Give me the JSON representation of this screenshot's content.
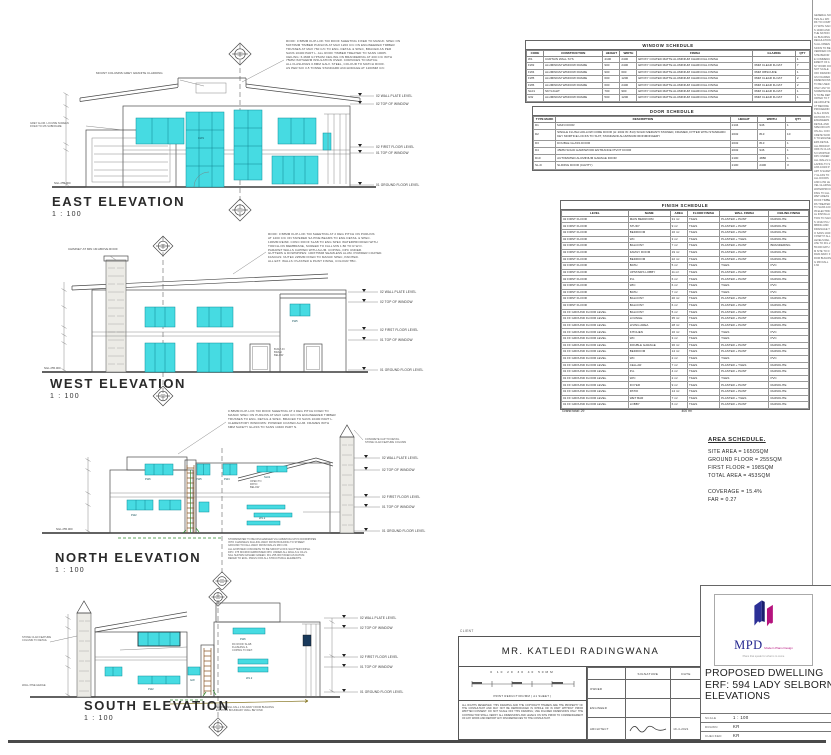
{
  "levels": [
    "02 WALL PLATE LEVEL",
    "02 TOP OF WINDOW",
    "02 FIRST FLOOR LEVEL",
    "01 TOP OF WINDOW",
    "01 GROUND FLOOR LEVEL"
  ],
  "ngl": "NGL 255.000",
  "win_tags": [
    "FW6",
    "FW5",
    "FW4",
    "FW2",
    "W1.2",
    "GW",
    "SL01",
    "CW1"
  ],
  "elevations": {
    "east": {
      "label": "EAST ELEVATION",
      "scale": "1 : 100"
    },
    "west": {
      "label": "WEST ELEVATION",
      "scale": "1 : 100"
    },
    "north": {
      "label": "NORTH ELEVATION",
      "scale": "1 : 100"
    },
    "south": {
      "label": "SOUTH ELEVATION",
      "scale": "1 : 100"
    }
  },
  "notes": {
    "east": [
      "ROOF: 0.58MM KLIP-LOK 700 ROOF SHEETING FIXED TO MANUF. SPEC ON",
      "50X76MM TIMBER PURLINS AT MAX 1200 C/C ON ENGINEERED TIMBER",
      "TRUSSES AT MAX 760 C/C TO ENG. DETAIL & SPEC, BRACED AS PER",
      "SANS 10400 PART L. ALL ROOF TIMBER TREATED TO SANS 10005.",
      "CEILING: 6.4MM GYPSUM CEILING ON BRANDERING AT 400 C/C WITH",
      "75MM ISOTHERM INSULATION OVER. CORNICES TO MATCH.",
      "ALL FLASHINGS 0.8MM GALV. STEEL, COLOUR TO MATCH ROOF.",
      "AS PER SOI 3-5 TONNE STANDARD ANCHORAGE AT 1200MM C/C"
    ],
    "east_left": [
      "GREY ALUM. LOUVRE SCREEN",
      "FIXED TO MS SUBFRAME"
    ],
    "east_callout": "MOUNT COLUMNS GREY GRANITE CLADDING",
    "west": [
      "ROOF: 0.58MM KLIP-LOK 700 SHEETING AT 2 DEG PITCH ON PURLINS",
      "AT 1200 C/C ON TAPERED SA PINE BEAMS TO ENG DETAIL & SPEC.",
      "130MM REINF. CONC ROOF SLAB TO ENG SPEC WATERPROOFED WITH",
      "TORCH-ON MEMBRANE, SCREED TO FALL MIN 1:80 TO R.W.O.",
      "PARAPET WALLS CAPPED WITH ALUM. COPING, DPC UNDER.",
      "GUTTERS & DOWNPIPES: 100X75MM SEAMLESS ALUM. POWDER COATED.",
      "FASCIAS: NUTEC 225MM FIXED TO MANUF SPEC, PAINTED.",
      "ALL EXT. WALLS: PLASTER & PAINT FINISH, COLOUR TBC."
    ],
    "west_callout": "CHIMNEY AT MIN 1M ABOVE ROOF",
    "west_mid": [
      "BUILT-IN",
      "BRAAI",
      "BELOW"
    ],
    "north_top": [
      "0.58MM KLIP-LOK 700 ROOF SHEETING AT 2 DEG PITCH FIXED TO",
      "MANUF SPEC ON PURLINS AT MAX 1200 C/C ON ENGINEERED TIMBER",
      "TRUSSES TO ENG. DETAIL & SPEC. BRACED TO SANS 10400 PART L.",
      "CLERESTORY WINDOWS: POWDER COATED ALUM. FRAMES WITH",
      "6MM SAFETY GLASS TO SANS 10400 PART N."
    ],
    "north_tower": [
      "CONCRETE CAP TO DETAIL",
      "STONE CLAD FEATURE COLUMN"
    ],
    "north_right": [
      "OPEN TO",
      "PATIO",
      "BELOW"
    ],
    "north_bottom": [
      "STORMWATER TO BE DISCHARGED VIA 110MM DIA UPVC DOWNPIPES",
      "INTO CHANNELS FALLING AWAY FROM BUILDING TO STREET.",
      "GROUND TO FALL AWAY FROM WALLS MIN 1:60.",
      "ALL EXPOSED CONCRETE TO BE SMOOTH OFF-SHUTTER FINISH.",
      "DPC: 375 MICRON EMBOSSED DPC UNDER ALL WALLS & CILLS.",
      "NGL SHOWN DASHED GREEN. FFL 255.000 TAKEN AS DATUM.",
      "REFER TO ENG. DWGS FOR ALL STRUCTURAL ELEMENTS."
    ],
    "south_left": [
      "STONE CLAD FEATURE",
      "COLUMN TO DETAIL"
    ],
    "south_hedge": "WALL PINE HEDGE",
    "south_mid": [
      "RC ROOF SLAB",
      "FLASHING &",
      "COPING TO DET."
    ],
    "south_olive": [
      "SLOPED NGL FALL 1:60 AWAY FROM BUILDING",
      "EXISTING BOUNDARY WALL BEYOND"
    ]
  },
  "window_schedule": {
    "title": "WINDOW SCHEDULE",
    "columns": [
      "CODE",
      "CONSTRUCTION",
      "HEIGHT",
      "WIDTH",
      "FINISH",
      "GLAZING",
      "QTY"
    ],
    "rows": [
      [
        "W1",
        "CURTAIN WALL SYS",
        "4100",
        "2400",
        "EPOXY COATED MATTE ALUMINIUM CHARCOAL FINISH",
        "",
        "1"
      ],
      [
        "FW2",
        "ALUMINIUM WINDOW FRAME",
        "900",
        "2400",
        "EPOXY COATED MATTE ALUMINIUM CHARCOAL FINISH",
        "6MM CLEAR FLOAT",
        "7"
      ],
      [
        "FW4",
        "ALUMINIUM WINDOW FRAME",
        "900",
        "600",
        "EPOXY COATED MATTE ALUMINIUM CHARCOAL FINISH",
        "6MM OBSCURE",
        "1"
      ],
      [
        "FW5",
        "ALUMINIUM WINDOW FRAME",
        "600",
        "1200",
        "EPOXY COATED MATTE ALUMINIUM CHARCOAL FINISH",
        "6MM CLEAR FLOAT",
        "2"
      ],
      [
        "FW6",
        "ALUMINIUM WINDOW FRAME",
        "600",
        "2400",
        "EPOXY COATED MATTE ALUMINIUM CHARCOAL FINISH",
        "6MM CLEAR FLOAT",
        "2"
      ],
      [
        "SL01",
        "SKYLIGHT",
        "700",
        "900",
        "EPOXY COATED MATTE ALUMINIUM CHARCOAL FINISH",
        "6MM CLEAR FLOAT",
        "1"
      ],
      [
        "GW",
        "ALUMINIUM WINDOW FRAME",
        "500",
        "1200",
        "EPOXY COATED MATTE ALUMINIUM CHARCOAL FINISH",
        "6MM CLEAR FLOAT",
        "1"
      ]
    ]
  },
  "door_schedule": {
    "title": "DOOR SCHEDULE",
    "columns": [
      "TYPE MARK",
      "DESCRIPTION",
      "HEIGHT",
      "WIDTH",
      "QTY"
    ],
    "rows": [
      [
        "D1",
        "MAIN DOOR",
        "2134",
        "946",
        "1"
      ],
      [
        "D2",
        "SINGLE FLUSH HOLLOW CORE DOOR (H: 2032 W: 813) SOLID MERANTI STAINED, FRAMED, FITTED WITH STANDARD KEY MORTICE LOCKS TO SUIT, STANDARD ALUMINIUM IRONMONGERY",
        "2032",
        "813",
        "10"
      ],
      [
        "D3",
        "DOUBLE GLASS DOOR",
        "2032",
        "813",
        "1"
      ],
      [
        "D4",
        "45MM SOLID HARDWOOD ENTRANCE PIVOT DOOR",
        "2032",
        "946",
        "1"
      ],
      [
        "D10",
        "AUTOMATED ALUMINIUM GARAGE DOOR",
        "2100",
        "4880",
        "1"
      ],
      [
        "SL-D",
        "SLIDING DOOR (CAVITY)",
        "2100",
        "2400",
        "3"
      ]
    ]
  },
  "finish_schedule": {
    "title": "FINISH SCHEDULE",
    "columns": [
      "LEVEL",
      "NAME",
      "AREA",
      "FLOOR FINISH",
      "WALL FINISH",
      "CEILING FINISH"
    ],
    "rows": [
      [
        "02 FIRST FLOOR",
        "MAIN BEDROOM",
        "31 m²",
        "TILES",
        "PLASTER + PAINT",
        "RHINOLITE"
      ],
      [
        "02 FIRST FLOOR",
        "STUDY",
        "9 m²",
        "TILES",
        "PLASTER + PAINT",
        "RHINOLITE"
      ],
      [
        "02 FIRST FLOOR",
        "BEDROOM",
        "16 m²",
        "TILES",
        "PLASTER + PAINT",
        "RHINOLITE"
      ],
      [
        "02 FIRST FLOOR",
        "WC",
        "3 m²",
        "TILES",
        "PLASTER + TILES",
        "RHINOLITE"
      ],
      [
        "02 FIRST FLOOR",
        "BALCONY",
        "7 m²",
        "TILES",
        "PLASTER + PAINT",
        "BRANDERING"
      ],
      [
        "02 FIRST FLOOR",
        "FAMILY ROOM",
        "19 m²",
        "TILES",
        "PLASTER + PAINT",
        "RHINOLITE"
      ],
      [
        "02 FIRST FLOOR",
        "BEDROOM",
        "22 m²",
        "TILES",
        "PLASTER + PAINT",
        "RHINOLITE"
      ],
      [
        "02 FIRST FLOOR",
        "BATH",
        "5 m²",
        "TILES",
        "TILES",
        "PVC"
      ],
      [
        "02 FIRST FLOOR",
        "UPSTAIRS LOBBY",
        "11 m²",
        "TILES",
        "PLASTER + PAINT",
        "RHINOLITE"
      ],
      [
        "02 FIRST FLOOR",
        "P.A.",
        "6 m²",
        "TILES",
        "PLASTER + PAINT",
        "RHINOLITE"
      ],
      [
        "02 FIRST FLOOR",
        "WIC",
        "6 m²",
        "TILES",
        "TILES",
        "PVC"
      ],
      [
        "02 FIRST FLOOR",
        "BATH",
        "7 m²",
        "TILES",
        "TILES",
        "PVC"
      ],
      [
        "02 FIRST FLOOR",
        "BALCONY",
        "20 m²",
        "TILES",
        "PLASTER + PAINT",
        "RHINOLITE"
      ],
      [
        "02 FIRST FLOOR",
        "BALCONY",
        "6 m²",
        "TILES",
        "PLASTER + PAINT",
        "RHINOLITE"
      ],
      [
        "01 FF GROUND FLOOR LEVEL",
        "BALCONY",
        "5 m²",
        "TILES",
        "PLASTER + PAINT",
        "RHINOLITE"
      ],
      [
        "01 FF GROUND FLOOR LEVEL",
        "LOUNGE",
        "35 m²",
        "TILES",
        "PLASTER + PAINT",
        "RHINOLITE"
      ],
      [
        "01 FF GROUND FLOOR LEVEL",
        "LIVING AREA",
        "28 m²",
        "TILES",
        "PLASTER + PAINT",
        "RHINOLITE"
      ],
      [
        "01 FF GROUND FLOOR LEVEL",
        "KITCHEN",
        "16 m²",
        "TILES",
        "TILES",
        "PVC"
      ],
      [
        "01 FF GROUND FLOOR LEVEL",
        "WC",
        "3 m²",
        "TILES",
        "TILES",
        "PVC"
      ],
      [
        "01 FF GROUND FLOOR LEVEL",
        "DOUBLE GARAGE",
        "36 m²",
        "TILES",
        "PLASTER + PAINT",
        "RHINOLITE"
      ],
      [
        "01 FF GROUND FLOOR LEVEL",
        "BEDROOM",
        "14 m²",
        "TILES",
        "PLASTER + PAINT",
        "RHINOLITE"
      ],
      [
        "01 FF GROUND FLOOR LEVEL",
        "WC",
        "2 m²",
        "TILES",
        "TILES",
        "PVC"
      ],
      [
        "01 FF GROUND FLOOR LEVEL",
        "CELLAR",
        "7 m²",
        "TILES",
        "PLASTER + TILES",
        "RHINOLITE"
      ],
      [
        "01 FF GROUND FLOOR LEVEL",
        "P.A.",
        "4 m²",
        "TILES",
        "PLASTER + PAINT",
        "RHINOLITE"
      ],
      [
        "01 FF GROUND FLOOR LEVEL",
        "W/C",
        "2 m²",
        "TILES",
        "TILES",
        "PVC"
      ],
      [
        "01 FF GROUND FLOOR LEVEL",
        "FOYER",
        "9 m²",
        "TILES",
        "PLASTER + PAINT",
        "RHINOLITE"
      ],
      [
        "01 FF GROUND FLOOR LEVEL",
        "PATIO",
        "14 m²",
        "TILES",
        "PLASTER + PAINT",
        "RHINOLITE"
      ],
      [
        "01 FF GROUND FLOOR LEVEL",
        "WET BAR",
        "7 m²",
        "TILES",
        "PLASTER + TILES",
        "RHINOLITE"
      ],
      [
        "01 FF GROUND FLOOR LEVEL",
        "LOBBY",
        "6 m²",
        "TILES",
        "PLASTER + PAINT",
        "RHINOLITE"
      ]
    ],
    "total_label": "Grand total: 29",
    "total_area": "400 m²"
  },
  "area_schedule": {
    "title": "AREA SCHEDULE.",
    "lines": [
      "SITE AREA = 1650SQM",
      "GROUND FLOOR = 255SQM",
      "FIRST FLOOR = 198SQM",
      "TOTAL AREA = 453SQM",
      "",
      "COVERAGE = 15.4%",
      "FAR = 0.27"
    ]
  },
  "title_block": {
    "logo_text": "MPD",
    "logo_name": "Modern Plans Design",
    "logo_tagline": "Plans that speak for what is to come",
    "project_line1": "PROPOSED DWELLING",
    "project_line2": "ERF: 594 LADY SELBORNE",
    "project_line3": "ELEVATIONS",
    "meta": [
      {
        "label": "SCALE",
        "value": "1 : 100"
      },
      {
        "label": "DRAWN",
        "value": "KR"
      },
      {
        "label": "CHECKED",
        "value": "KR"
      }
    ]
  },
  "client_block": {
    "label": "CLIENT",
    "name": "MR. KATLEDI RADINGWANA",
    "scale_numbers": "0    10    20    30    40    50MM",
    "scale_caption": "PRINT REDUCTION/MM ( A1 SHEET )",
    "disclaimer": "ALL RIGHTS RESERVED. THIS DRAWING AND THE COPYRIGHT THEREIN ARE THE PROPERTY OF THE CONSULTANT AND MAY NOT BE REPRODUCED IN WHOLE OR IN PART WITHOUT PRIOR WRITTEN CONSENT. DO NOT SCALE OFF THIS DRAWING; USE FIGURED DIMENSIONS ONLY. THE CONTRACTOR SHALL VERIFY ALL DIMENSIONS AND LEVELS ON SITE PRIOR TO COMMENCEMENT OF ANY WORK AND REPORT ANY DISCREPANCIES TO THE CONSULTANT.",
    "signature": {
      "sig_col": "SIGNATURE",
      "date_col": "DATE",
      "rows": [
        "OWNER",
        "ENGINEER",
        "ARCHITECT"
      ],
      "architect_date": "19-4-2021"
    }
  },
  "side_notes": "GENERAL NOTES ALL WORK TO COMPLY WITH SANS 10400 AND THE NATIONAL BUILDING REGULATIONS ALL DIMENSIONS TO BE VERIFIED ON SITE BEFORE COMMENCEMENT OF ANY WORK DO NOT SCALE OFF DRAWINGS FIGURED DIMENSIONS TO BE USED ONLY ANY DISCREPANCIES TO BE REPORTED TO THE ARCHITECT BEFORE PROCEEDING ALL FOUNDATIONS TO ENGINEERS DETAIL AND SPECIFICATION ALL CONCRETE WORK TO ENGINEERS DETAIL ALL BRICKWORK IN CLASS II MORTAR DPC UNDER ALL WALLS GLAZING TO SANS 10400 PART N SAFETY GLASS TO ALL DOORS AND LOW LEVEL GLAZING WATERPROOFING TO ALL WET AREAS ROOF TIMBERS TREATED TO SANS 10005 ELECTRICAL INSTALLATION TO SANS 10142 PLUMBING AND DRAINAGE TO SANS 10400 PART P ALL LEVELS RELATE TO FFL 255.000 DATUM SITE TO DRAIN AWAY FROM BUILDING MIN FALL 1:60"
}
